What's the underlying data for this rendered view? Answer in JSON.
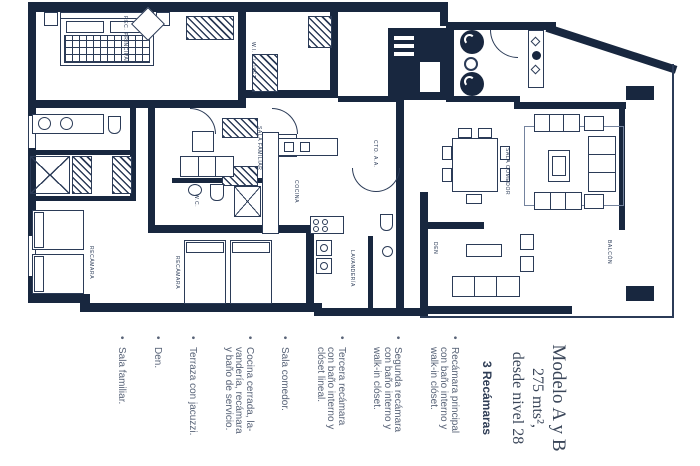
{
  "page": {
    "background": "#ffffff",
    "ink": "#18273f",
    "line_color": "#2b3b57"
  },
  "info_panel": {
    "title_lines": [
      "Modelo A y B",
      "275 mts²,",
      "desde nivel 28"
    ],
    "subtitle": "3 Recámaras",
    "features": [
      "Recámara principal\ncon baño interno y\nwalk-in clóset.",
      "Segunda recámara\ncon baño interno y\nwalk-in clóset.",
      "Tercera recámara\ncon baño interno y\nclóset lineal.",
      "Sala comedor.",
      "Cocina cerrada, la-\nvandería, recámara\ny baño de servicio.",
      "Terraza con jacuzzi.",
      "Den.",
      "Sala familiar."
    ]
  },
  "plan": {
    "labels": {
      "rec_principal": "REC. PRINCIPAL",
      "wi_closet": "W.I. CLOSET",
      "sala_familiar": "SALA FAMILIAR",
      "cocina": "COCINA",
      "cto_aa": "CTO. A.A.",
      "den": "DEN",
      "sala_comedor": "SALA COMEDOR",
      "balcon": "BALCÓN",
      "recamara_2": "RECÁMARA",
      "recamara_3": "RECÁMARA",
      "lavanderia": "LAVANDERÍA",
      "wc": "W.C."
    }
  }
}
